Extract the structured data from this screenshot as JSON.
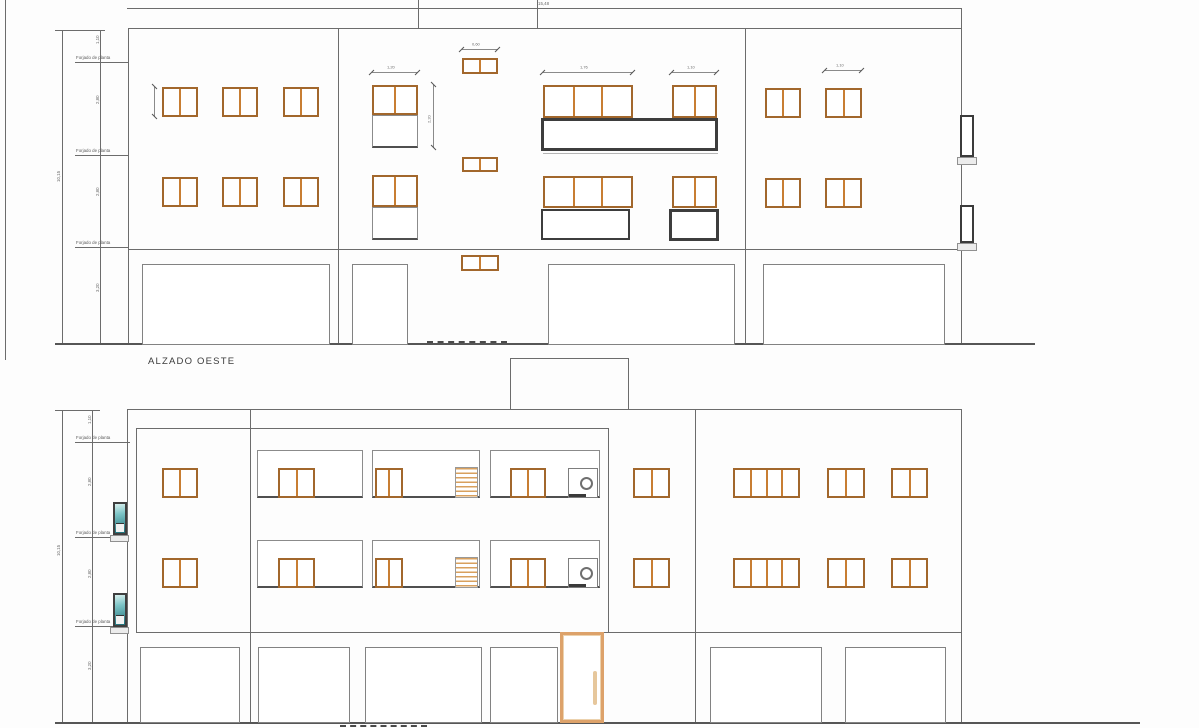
{
  "meta": {
    "drawing_type": "architectural elevations",
    "sheet": "white"
  },
  "colors": {
    "line": "#6c6c6c",
    "line_faint": "#b5b5b5",
    "line_dark": "#4a4a4a",
    "ground": "#565656",
    "frame": "#a2672c",
    "mullion": "#c87e33",
    "railing": "#3d3d3d",
    "stairs": "#d8a05e",
    "teal": "#1e6f78",
    "door": "#dda26a",
    "text": "#3b3b3b"
  },
  "top": {
    "title": "ALZADO OESTE",
    "lines": [
      [
        5,
        0,
        1,
        360,
        "n"
      ],
      [
        62,
        30,
        1,
        315,
        "n"
      ],
      [
        100,
        30,
        1,
        315,
        "n"
      ],
      [
        55,
        30,
        50,
        1,
        "n"
      ],
      [
        127,
        8,
        834,
        1,
        "n"
      ],
      [
        961,
        8,
        1,
        20,
        "n"
      ],
      [
        418,
        0,
        1,
        28,
        "n"
      ],
      [
        537,
        0,
        1,
        28,
        "n"
      ],
      [
        128,
        28,
        834,
        1,
        "n"
      ],
      [
        128,
        28,
        1,
        317,
        "n"
      ],
      [
        961,
        28,
        1,
        317,
        "n"
      ],
      [
        338,
        28,
        1,
        317,
        "n"
      ],
      [
        745,
        28,
        1,
        317,
        "n"
      ],
      [
        128,
        249,
        834,
        1,
        "n"
      ],
      [
        543,
        153,
        175,
        1,
        "f"
      ]
    ],
    "ground": [
      55,
      343,
      980
    ],
    "dashed": [
      [
        427,
        341,
        80
      ]
    ],
    "floor_ticks": [
      [
        75,
        62,
        53
      ],
      [
        75,
        155,
        53
      ],
      [
        75,
        247,
        53
      ]
    ],
    "floor_labels": [
      "Forjado de planta",
      "Forjado de planta",
      "Forjado de planta"
    ],
    "windows": [
      [
        162,
        87,
        36,
        30,
        2
      ],
      [
        222,
        87,
        36,
        30,
        2
      ],
      [
        283,
        87,
        36,
        30,
        2
      ],
      [
        162,
        177,
        36,
        30,
        2
      ],
      [
        222,
        177,
        36,
        30,
        2
      ],
      [
        283,
        177,
        36,
        30,
        2
      ],
      [
        372,
        85,
        46,
        30,
        2
      ],
      [
        372,
        175,
        46,
        32,
        2
      ],
      [
        462,
        58,
        36,
        16,
        2
      ],
      [
        462,
        157,
        36,
        15,
        2
      ],
      [
        461,
        255,
        38,
        16,
        2
      ],
      [
        543,
        85,
        90,
        33,
        3
      ],
      [
        672,
        85,
        45,
        33,
        2
      ],
      [
        543,
        176,
        90,
        32,
        3
      ],
      [
        672,
        176,
        45,
        32,
        2
      ],
      [
        765,
        88,
        36,
        30,
        2
      ],
      [
        825,
        88,
        37,
        30,
        2
      ],
      [
        765,
        178,
        36,
        30,
        2
      ],
      [
        825,
        178,
        37,
        30,
        2
      ]
    ],
    "panels": [
      [
        372,
        115,
        46,
        33
      ],
      [
        372,
        207,
        46,
        33
      ]
    ],
    "railings": [
      [
        541,
        118,
        177,
        33,
        3
      ],
      [
        541,
        209,
        89,
        31,
        2
      ],
      [
        669,
        209,
        50,
        32,
        3
      ]
    ],
    "openings": [
      [
        142,
        264,
        188,
        81
      ],
      [
        352,
        264,
        56,
        81
      ],
      [
        548,
        264,
        187,
        81
      ],
      [
        763,
        264,
        182,
        81
      ]
    ],
    "side_windows": [
      [
        960,
        115,
        14,
        42
      ],
      [
        960,
        205,
        14,
        38
      ]
    ],
    "sills": [
      [
        957,
        157,
        20,
        8
      ],
      [
        957,
        243,
        20,
        8
      ]
    ],
    "stairs": [],
    "circle_units": [],
    "teal_windows": [],
    "door": null,
    "dims_h": [
      [
        372,
        72,
        46,
        "1,20"
      ],
      [
        462,
        49,
        36,
        "0,60"
      ],
      [
        543,
        72,
        90,
        "1,76"
      ],
      [
        672,
        72,
        45,
        "1,10"
      ],
      [
        825,
        70,
        37,
        "1,10"
      ]
    ],
    "dims_v": [
      [
        154,
        87,
        30,
        ""
      ],
      [
        433,
        85,
        63,
        "2,20"
      ]
    ],
    "tiny_labels": [
      [
        538,
        1,
        "15,48",
        0
      ],
      [
        56,
        182,
        "10,15",
        -90
      ],
      [
        95,
        44,
        "1,10",
        -90
      ],
      [
        95,
        104,
        "2,80",
        -90
      ],
      [
        95,
        196,
        "2,80",
        -90
      ],
      [
        95,
        292,
        "3,20",
        -90
      ]
    ]
  },
  "bottom": {
    "lines": [
      [
        62,
        410,
        1,
        313,
        "n"
      ],
      [
        92,
        410,
        1,
        313,
        "n"
      ],
      [
        55,
        410,
        45,
        1,
        "n"
      ],
      [
        127,
        409,
        835,
        1,
        "n"
      ],
      [
        127,
        409,
        1,
        314,
        "n"
      ],
      [
        136,
        428,
        1,
        204,
        "n"
      ],
      [
        136,
        428,
        472,
        1,
        "n"
      ],
      [
        608,
        428,
        1,
        204,
        "n"
      ],
      [
        250,
        409,
        1,
        314,
        "n"
      ],
      [
        695,
        410,
        1,
        313,
        "n"
      ],
      [
        961,
        410,
        1,
        313,
        "n"
      ],
      [
        510,
        358,
        1,
        52,
        "n"
      ],
      [
        510,
        358,
        119,
        1,
        "n"
      ],
      [
        628,
        358,
        1,
        52,
        "n"
      ],
      [
        136,
        632,
        825,
        1,
        "n"
      ]
    ],
    "ground": [
      55,
      722,
      1085
    ],
    "dashed": [
      [
        340,
        725,
        87
      ]
    ],
    "floor_ticks": [
      [
        75,
        442,
        55
      ],
      [
        75,
        537,
        52
      ],
      [
        75,
        626,
        52
      ]
    ],
    "floor_labels": [
      "Forjado de planta",
      "Forjado de planta",
      "Forjado de planta"
    ],
    "panels": [
      [
        257,
        450,
        106,
        48
      ],
      [
        372,
        450,
        108,
        48
      ],
      [
        490,
        450,
        110,
        48
      ],
      [
        257,
        540,
        106,
        48
      ],
      [
        372,
        540,
        108,
        48
      ],
      [
        490,
        540,
        110,
        48
      ]
    ],
    "windows": [
      [
        162,
        468,
        36,
        30,
        2
      ],
      [
        278,
        468,
        37,
        30,
        2
      ],
      [
        375,
        468,
        28,
        30,
        2
      ],
      [
        510,
        468,
        36,
        30,
        2
      ],
      [
        633,
        468,
        37,
        30,
        2
      ],
      [
        733,
        468,
        67,
        30,
        4
      ],
      [
        827,
        468,
        38,
        30,
        2
      ],
      [
        891,
        468,
        37,
        30,
        2
      ],
      [
        162,
        558,
        36,
        30,
        2
      ],
      [
        278,
        558,
        37,
        30,
        2
      ],
      [
        375,
        558,
        28,
        30,
        2
      ],
      [
        510,
        558,
        36,
        30,
        2
      ],
      [
        633,
        558,
        37,
        30,
        2
      ],
      [
        733,
        558,
        67,
        30,
        4
      ],
      [
        827,
        558,
        38,
        30,
        2
      ],
      [
        891,
        558,
        37,
        30,
        2
      ]
    ],
    "railings": [],
    "openings": [
      [
        140,
        647,
        100,
        76
      ],
      [
        258,
        647,
        92,
        76
      ],
      [
        365,
        647,
        117,
        76
      ],
      [
        490,
        647,
        68,
        76
      ],
      [
        710,
        647,
        112,
        76
      ],
      [
        845,
        647,
        101,
        76
      ]
    ],
    "side_windows": [],
    "sills": [
      [
        110,
        535,
        19,
        7
      ],
      [
        110,
        627,
        19,
        7
      ]
    ],
    "stairs": [
      [
        455,
        467,
        23,
        31
      ],
      [
        455,
        557,
        23,
        31
      ]
    ],
    "circle_units": [
      [
        568,
        468,
        30,
        30
      ],
      [
        568,
        558,
        30,
        30
      ]
    ],
    "teal_windows": [
      [
        113,
        502,
        14,
        33
      ],
      [
        113,
        593,
        14,
        34
      ]
    ],
    "door": [
      560,
      632,
      44,
      91
    ],
    "dims_h": [],
    "dims_v": [],
    "tiny_labels": [
      [
        56,
        556,
        "10,15",
        -90
      ],
      [
        87,
        424,
        "1,10",
        -90
      ],
      [
        87,
        486,
        "2,80",
        -90
      ],
      [
        87,
        578,
        "2,80",
        -90
      ],
      [
        87,
        670,
        "3,20",
        -90
      ]
    ]
  }
}
